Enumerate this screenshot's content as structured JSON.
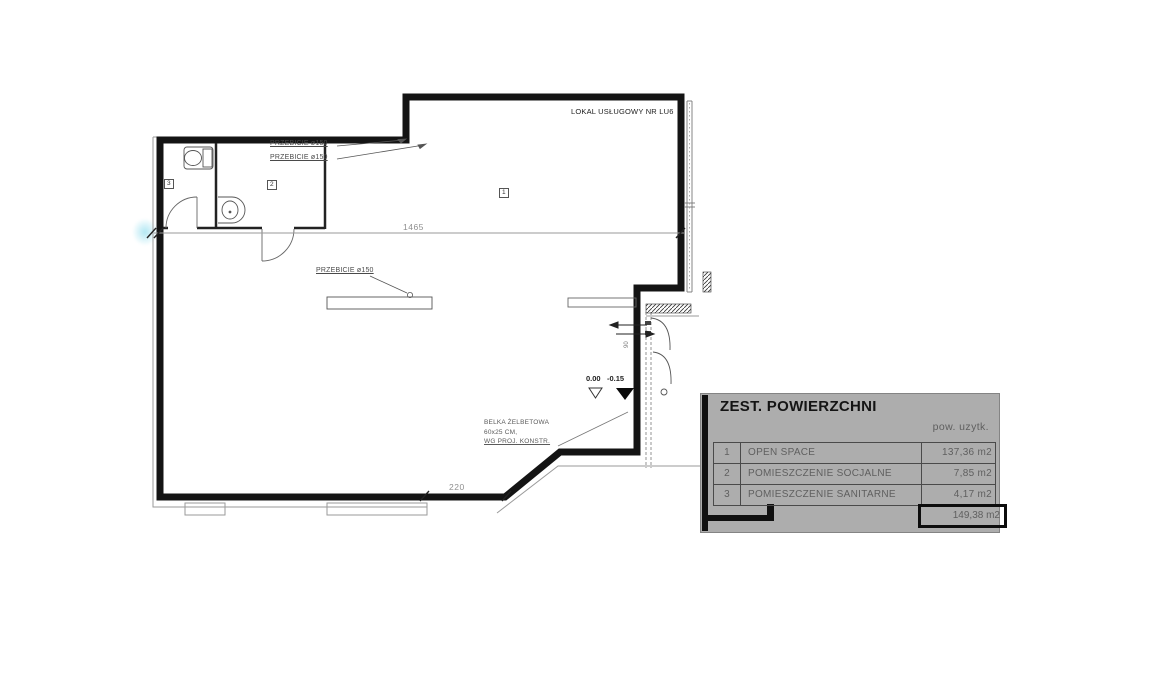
{
  "plan": {
    "unit_label": "LOKAL USŁUGOWY NR LU6",
    "penetration_label_1": "PRZEBICIE ø150",
    "penetration_label_2": "PRZEBICIE ø150",
    "penetration_label_3": "PRZEBICIE ø150",
    "room_tags": {
      "open_space": "1",
      "social": "2",
      "sanitary": "3"
    },
    "dim_width": "1465",
    "dim_entry": "220",
    "door_width": "90",
    "elev_zero": "0.00",
    "elev_minus": "-0.15",
    "beam_note_line1": "BELKA ŻELBETOWA",
    "beam_note_line2": "60x25 CM,",
    "beam_note_line3": "WG PROJ. KONSTR."
  },
  "panel": {
    "title": "ZEST. POWIERZCHNI",
    "column_header": "pow. uzytk.",
    "rows": [
      {
        "num": "1",
        "name": "OPEN SPACE",
        "area": "137,36 m2"
      },
      {
        "num": "2",
        "name": "POMIESZCZENIE SOCJALNE",
        "area": "7,85 m2"
      },
      {
        "num": "3",
        "name": "POMIESZCZENIE SANITARNE",
        "area": "4,17 m2"
      }
    ],
    "total_area": "149,38 m2"
  },
  "colors": {
    "wall": "#141414",
    "panel_background": "#adadad",
    "dim_text": "#8f8f8f",
    "highlight": "#7dd7eb"
  }
}
